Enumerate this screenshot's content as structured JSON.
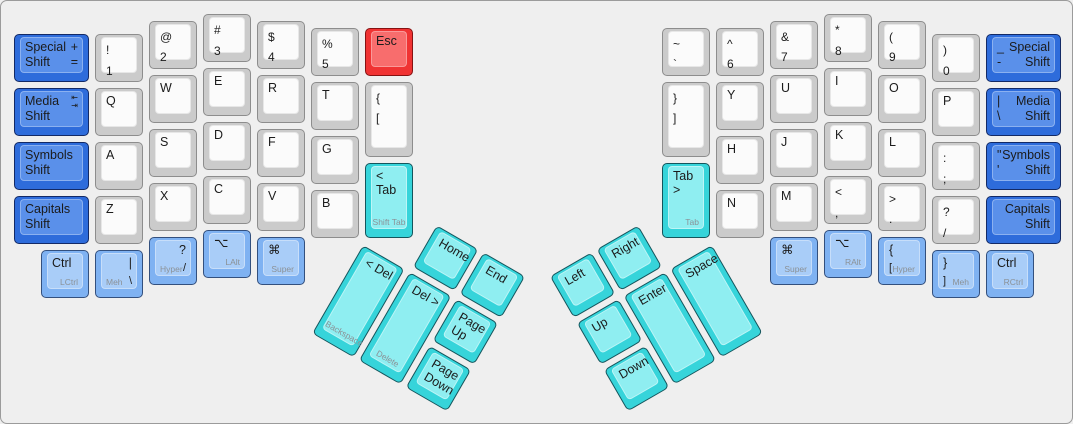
{
  "canvas": {
    "width": 1073,
    "height": 424,
    "background": "#efefef",
    "border_color": "#9b9b9b"
  },
  "unit_px": 54,
  "pad_px": 10,
  "inset_px": 3,
  "palette": {
    "white": {
      "base": "#cbcbcb",
      "top": "#fbfbfb",
      "border": "#8d8d8d",
      "topBorder": "rgba(0,0,0,0.08)"
    },
    "blue": {
      "base": "#2e6cdb",
      "top": "#5a90ea",
      "border": "#132a66",
      "topBorder": "rgba(255,255,255,0.30)"
    },
    "mod": {
      "base": "#7fb2f2",
      "top": "#a9cdf8",
      "border": "#33507e",
      "topBorder": "rgba(255,255,255,0.35)"
    },
    "cyan": {
      "base": "#36d4da",
      "top": "#8feef1",
      "border": "#14555c",
      "topBorder": "rgba(255,255,255,0.40)"
    },
    "red": {
      "base": "#f03333",
      "top": "#f86d6d",
      "border": "#861212",
      "topBorder": "rgba(255,255,255,0.30)"
    }
  },
  "keys": [
    {
      "n": "key-special-shift-left",
      "x": 0,
      "y": 0.375,
      "w": 1.5,
      "c": "blue",
      "l": [
        [
          "tl",
          "main",
          "Special\nShift"
        ],
        [
          "tr",
          "main",
          "+\n="
        ]
      ]
    },
    {
      "n": "key-media-shift-left",
      "x": 0,
      "y": 1.375,
      "w": 1.5,
      "c": "blue",
      "l": [
        [
          "tl",
          "main",
          "Media\nShift"
        ],
        [
          "tr",
          "icon",
          "⇤\n⇥",
          "tab-arrows-icon"
        ]
      ]
    },
    {
      "n": "key-symbols-shift-left",
      "x": 0,
      "y": 2.375,
      "w": 1.5,
      "c": "blue",
      "l": [
        [
          "tl",
          "main",
          "Symbols\nShift"
        ]
      ]
    },
    {
      "n": "key-capitals-shift-left",
      "x": 0,
      "y": 3.375,
      "w": 1.5,
      "c": "blue",
      "l": [
        [
          "tl",
          "main",
          "Capitals\nShift"
        ]
      ]
    },
    {
      "n": "key-1",
      "x": 1.5,
      "y": 0.375,
      "c": "white",
      "l": [
        [
          "tl",
          "pair",
          "!\n1"
        ]
      ]
    },
    {
      "n": "key-q",
      "x": 1.5,
      "y": 1.375,
      "c": "white",
      "l": [
        [
          "tl",
          "main",
          "Q"
        ]
      ]
    },
    {
      "n": "key-a",
      "x": 1.5,
      "y": 2.375,
      "c": "white",
      "l": [
        [
          "tl",
          "main",
          "A"
        ]
      ]
    },
    {
      "n": "key-z",
      "x": 1.5,
      "y": 3.375,
      "c": "white",
      "l": [
        [
          "tl",
          "main",
          "Z"
        ]
      ]
    },
    {
      "n": "key-2",
      "x": 2.5,
      "y": 0.125,
      "c": "white",
      "l": [
        [
          "tl",
          "pair",
          "@\n2"
        ]
      ]
    },
    {
      "n": "key-w",
      "x": 2.5,
      "y": 1.125,
      "c": "white",
      "l": [
        [
          "tl",
          "main",
          "W"
        ]
      ]
    },
    {
      "n": "key-s",
      "x": 2.5,
      "y": 2.125,
      "c": "white",
      "l": [
        [
          "tl",
          "main",
          "S"
        ]
      ]
    },
    {
      "n": "key-x",
      "x": 2.5,
      "y": 3.125,
      "c": "white",
      "l": [
        [
          "tl",
          "main",
          "X"
        ]
      ]
    },
    {
      "n": "key-3",
      "x": 3.5,
      "y": 0,
      "c": "white",
      "l": [
        [
          "tl",
          "pair",
          "#\n3"
        ]
      ]
    },
    {
      "n": "key-e",
      "x": 3.5,
      "y": 1,
      "c": "white",
      "l": [
        [
          "tl",
          "main",
          "E"
        ]
      ]
    },
    {
      "n": "key-d",
      "x": 3.5,
      "y": 2,
      "c": "white",
      "l": [
        [
          "tl",
          "main",
          "D"
        ]
      ]
    },
    {
      "n": "key-c",
      "x": 3.5,
      "y": 3,
      "c": "white",
      "l": [
        [
          "tl",
          "main",
          "C"
        ]
      ]
    },
    {
      "n": "key-4",
      "x": 4.5,
      "y": 0.125,
      "c": "white",
      "l": [
        [
          "tl",
          "pair",
          "$\n4"
        ]
      ]
    },
    {
      "n": "key-r",
      "x": 4.5,
      "y": 1.125,
      "c": "white",
      "l": [
        [
          "tl",
          "main",
          "R"
        ]
      ]
    },
    {
      "n": "key-f",
      "x": 4.5,
      "y": 2.125,
      "c": "white",
      "l": [
        [
          "tl",
          "main",
          "F"
        ]
      ]
    },
    {
      "n": "key-v",
      "x": 4.5,
      "y": 3.125,
      "c": "white",
      "l": [
        [
          "tl",
          "main",
          "V"
        ]
      ]
    },
    {
      "n": "key-5",
      "x": 5.5,
      "y": 0.25,
      "c": "white",
      "l": [
        [
          "tl",
          "pair",
          "%\n5"
        ]
      ]
    },
    {
      "n": "key-t",
      "x": 5.5,
      "y": 1.25,
      "c": "white",
      "l": [
        [
          "tl",
          "main",
          "T"
        ]
      ]
    },
    {
      "n": "key-g",
      "x": 5.5,
      "y": 2.25,
      "c": "white",
      "l": [
        [
          "tl",
          "main",
          "G"
        ]
      ]
    },
    {
      "n": "key-b",
      "x": 5.5,
      "y": 3.25,
      "c": "white",
      "l": [
        [
          "tl",
          "main",
          "B"
        ]
      ]
    },
    {
      "n": "key-esc",
      "x": 6.5,
      "y": 0.25,
      "c": "red",
      "l": [
        [
          "tl",
          "main",
          "Esc"
        ]
      ]
    },
    {
      "n": "key-lbracket-left",
      "x": 6.5,
      "y": 1.25,
      "h": 1.5,
      "c": "white",
      "l": [
        [
          "tl",
          "pair",
          "{\n["
        ]
      ]
    },
    {
      "n": "key-tab-left",
      "x": 6.5,
      "y": 2.75,
      "h": 1.5,
      "c": "cyan",
      "l": [
        [
          "tl",
          "main",
          "< Tab"
        ],
        [
          "bc",
          "sub",
          "Shift Tab"
        ]
      ]
    },
    {
      "n": "key-lctrl",
      "x": 0.5,
      "y": 4.375,
      "c": "mod",
      "l": [
        [
          "tl",
          "main",
          "Ctrl"
        ],
        [
          "lr",
          "sub",
          "LCtrl"
        ]
      ]
    },
    {
      "n": "key-meh-left",
      "x": 1.5,
      "y": 4.375,
      "c": "mod",
      "l": [
        [
          "tr",
          "main",
          "|"
        ],
        [
          "ll",
          "sub",
          "Meh"
        ],
        [
          "lr",
          "sym",
          "\\"
        ]
      ]
    },
    {
      "n": "key-hyper-left",
      "x": 2.5,
      "y": 4.125,
      "c": "mod",
      "l": [
        [
          "tr",
          "main",
          "?"
        ],
        [
          "ll",
          "sub",
          "Hyper"
        ],
        [
          "lr",
          "sym",
          "/"
        ]
      ]
    },
    {
      "n": "key-lalt",
      "x": 3.5,
      "y": 4,
      "c": "mod",
      "l": [
        [
          "tl",
          "main",
          "⌥",
          "option-icon"
        ],
        [
          "lr",
          "sub",
          "LAlt"
        ]
      ]
    },
    {
      "n": "key-super-left",
      "x": 4.5,
      "y": 4.125,
      "c": "mod",
      "l": [
        [
          "tl",
          "main",
          "⌘",
          "command-icon"
        ],
        [
          "lr",
          "sub",
          "Super"
        ]
      ]
    },
    {
      "n": "key-home",
      "x": 7.5,
      "y": 3.25,
      "c": "cyan",
      "r": 30,
      "rx": 6.5,
      "ry": 4.25,
      "l": [
        [
          "tl",
          "main",
          "Home"
        ]
      ]
    },
    {
      "n": "key-end",
      "x": 8.5,
      "y": 3.25,
      "c": "cyan",
      "r": 30,
      "rx": 6.5,
      "ry": 4.25,
      "l": [
        [
          "tl",
          "main",
          "End"
        ]
      ]
    },
    {
      "n": "key-backspace",
      "x": 6.5,
      "y": 4.25,
      "h": 2,
      "c": "cyan",
      "r": 30,
      "rx": 6.5,
      "ry": 4.25,
      "l": [
        [
          "tl",
          "main",
          "< Del"
        ],
        [
          "bc",
          "sub",
          "Backspace"
        ]
      ]
    },
    {
      "n": "key-delete",
      "x": 7.5,
      "y": 4.25,
      "h": 2,
      "c": "cyan",
      "r": 30,
      "rx": 6.5,
      "ry": 4.25,
      "l": [
        [
          "tl",
          "main",
          "Del >"
        ],
        [
          "bc",
          "sub",
          "Delete"
        ]
      ]
    },
    {
      "n": "key-page-up",
      "x": 8.5,
      "y": 4.25,
      "c": "cyan",
      "r": 30,
      "rx": 6.5,
      "ry": 4.25,
      "l": [
        [
          "tl",
          "main",
          "Page\nUp"
        ]
      ]
    },
    {
      "n": "key-page-down",
      "x": 8.5,
      "y": 5.25,
      "c": "cyan",
      "r": 30,
      "rx": 6.5,
      "ry": 4.25,
      "l": [
        [
          "tl",
          "main",
          "Page\nDown"
        ]
      ]
    },
    {
      "n": "key-left",
      "x": 10,
      "y": 3.25,
      "c": "cyan",
      "r": -30,
      "rx": 13,
      "ry": 4.25,
      "l": [
        [
          "tl",
          "main",
          "Left"
        ]
      ]
    },
    {
      "n": "key-right",
      "x": 11,
      "y": 3.25,
      "c": "cyan",
      "r": -30,
      "rx": 13,
      "ry": 4.25,
      "l": [
        [
          "tl",
          "main",
          "Right"
        ]
      ]
    },
    {
      "n": "key-up",
      "x": 10,
      "y": 4.25,
      "c": "cyan",
      "r": -30,
      "rx": 13,
      "ry": 4.25,
      "l": [
        [
          "tl",
          "main",
          "Up"
        ]
      ]
    },
    {
      "n": "key-enter",
      "x": 11,
      "y": 4.25,
      "h": 2,
      "c": "cyan",
      "r": -30,
      "rx": 13,
      "ry": 4.25,
      "l": [
        [
          "tl",
          "main",
          "Enter"
        ]
      ]
    },
    {
      "n": "key-space",
      "x": 12,
      "y": 4.25,
      "h": 2,
      "c": "cyan",
      "r": -30,
      "rx": 13,
      "ry": 4.25,
      "l": [
        [
          "tl",
          "main",
          "Space"
        ]
      ]
    },
    {
      "n": "key-down",
      "x": 10,
      "y": 5.25,
      "c": "cyan",
      "r": -30,
      "rx": 13,
      "ry": 4.25,
      "l": [
        [
          "tl",
          "main",
          "Down"
        ]
      ]
    },
    {
      "n": "key-tilde",
      "x": 12,
      "y": 0.25,
      "c": "white",
      "l": [
        [
          "tl",
          "pair",
          "~\n`"
        ]
      ]
    },
    {
      "n": "key-rbracket-right",
      "x": 12,
      "y": 1.25,
      "h": 1.5,
      "c": "white",
      "l": [
        [
          "tl",
          "pair",
          "}\n]"
        ]
      ]
    },
    {
      "n": "key-tab-right",
      "x": 12,
      "y": 2.75,
      "h": 1.5,
      "c": "cyan",
      "l": [
        [
          "tl",
          "main",
          "Tab >"
        ],
        [
          "lr",
          "sub",
          "Tab"
        ]
      ]
    },
    {
      "n": "key-6",
      "x": 13,
      "y": 0.25,
      "c": "white",
      "l": [
        [
          "tl",
          "pair",
          "^\n6"
        ]
      ]
    },
    {
      "n": "key-y",
      "x": 13,
      "y": 1.25,
      "c": "white",
      "l": [
        [
          "tl",
          "main",
          "Y"
        ]
      ]
    },
    {
      "n": "key-h",
      "x": 13,
      "y": 2.25,
      "c": "white",
      "l": [
        [
          "tl",
          "main",
          "H"
        ]
      ]
    },
    {
      "n": "key-n",
      "x": 13,
      "y": 3.25,
      "c": "white",
      "l": [
        [
          "tl",
          "main",
          "N"
        ]
      ]
    },
    {
      "n": "key-7",
      "x": 14,
      "y": 0.125,
      "c": "white",
      "l": [
        [
          "tl",
          "pair",
          "&\n7"
        ]
      ]
    },
    {
      "n": "key-u",
      "x": 14,
      "y": 1.125,
      "c": "white",
      "l": [
        [
          "tl",
          "main",
          "U"
        ]
      ]
    },
    {
      "n": "key-j",
      "x": 14,
      "y": 2.125,
      "c": "white",
      "l": [
        [
          "tl",
          "main",
          "J"
        ]
      ]
    },
    {
      "n": "key-m",
      "x": 14,
      "y": 3.125,
      "c": "white",
      "l": [
        [
          "tl",
          "main",
          "M"
        ]
      ]
    },
    {
      "n": "key-8",
      "x": 15,
      "y": 0,
      "c": "white",
      "l": [
        [
          "tl",
          "pair",
          "*\n8"
        ]
      ]
    },
    {
      "n": "key-i",
      "x": 15,
      "y": 1,
      "c": "white",
      "l": [
        [
          "tl",
          "main",
          "I"
        ]
      ]
    },
    {
      "n": "key-k",
      "x": 15,
      "y": 2,
      "c": "white",
      "l": [
        [
          "tl",
          "main",
          "K"
        ]
      ]
    },
    {
      "n": "key-comma",
      "x": 15,
      "y": 3,
      "c": "white",
      "l": [
        [
          "tl",
          "pair",
          "<\n,"
        ]
      ]
    },
    {
      "n": "key-9",
      "x": 16,
      "y": 0.125,
      "c": "white",
      "l": [
        [
          "tl",
          "pair",
          "(\n9"
        ]
      ]
    },
    {
      "n": "key-o",
      "x": 16,
      "y": 1.125,
      "c": "white",
      "l": [
        [
          "tl",
          "main",
          "O"
        ]
      ]
    },
    {
      "n": "key-l",
      "x": 16,
      "y": 2.125,
      "c": "white",
      "l": [
        [
          "tl",
          "main",
          "L"
        ]
      ]
    },
    {
      "n": "key-period",
      "x": 16,
      "y": 3.125,
      "c": "white",
      "l": [
        [
          "tl",
          "pair",
          ">\n."
        ]
      ]
    },
    {
      "n": "key-0",
      "x": 17,
      "y": 0.375,
      "c": "white",
      "l": [
        [
          "tl",
          "pair",
          ")\n0"
        ]
      ]
    },
    {
      "n": "key-p",
      "x": 17,
      "y": 1.375,
      "c": "white",
      "l": [
        [
          "tl",
          "main",
          "P"
        ]
      ]
    },
    {
      "n": "key-semicolon",
      "x": 17,
      "y": 2.375,
      "c": "white",
      "l": [
        [
          "tl",
          "pair",
          ":\n;"
        ]
      ]
    },
    {
      "n": "key-slash",
      "x": 17,
      "y": 3.375,
      "c": "white",
      "l": [
        [
          "tl",
          "pair",
          "?\n/"
        ]
      ]
    },
    {
      "n": "key-special-shift-right",
      "x": 18,
      "y": 0.375,
      "w": 1.5,
      "c": "blue",
      "l": [
        [
          "tl",
          "main",
          "_\n-"
        ],
        [
          "tr",
          "main",
          "Special\nShift"
        ]
      ]
    },
    {
      "n": "key-media-shift-right",
      "x": 18,
      "y": 1.375,
      "w": 1.5,
      "c": "blue",
      "l": [
        [
          "tl",
          "main",
          "|\n\\"
        ],
        [
          "tr",
          "main",
          "Media\nShift"
        ]
      ]
    },
    {
      "n": "key-symbols-shift-right",
      "x": 18,
      "y": 2.375,
      "w": 1.5,
      "c": "blue",
      "l": [
        [
          "tl",
          "main",
          "\"\n'"
        ],
        [
          "tr",
          "main",
          "Symbols\nShift"
        ]
      ]
    },
    {
      "n": "key-capitals-shift-right",
      "x": 18,
      "y": 3.375,
      "w": 1.5,
      "c": "blue",
      "l": [
        [
          "tr",
          "main",
          "Capitals\nShift"
        ]
      ]
    },
    {
      "n": "key-super-right",
      "x": 14,
      "y": 4.125,
      "c": "mod",
      "l": [
        [
          "tl",
          "main",
          "⌘",
          "command-icon"
        ],
        [
          "lr",
          "sub",
          "Super"
        ]
      ]
    },
    {
      "n": "key-ralt",
      "x": 15,
      "y": 4,
      "c": "mod",
      "l": [
        [
          "tl",
          "main",
          "⌥",
          "option-icon"
        ],
        [
          "lr",
          "sub",
          "RAlt"
        ]
      ]
    },
    {
      "n": "key-hyper-right",
      "x": 16,
      "y": 4.125,
      "c": "mod",
      "l": [
        [
          "tl",
          "main",
          "{"
        ],
        [
          "ll",
          "sym",
          "["
        ],
        [
          "lr",
          "sub",
          "Hyper"
        ]
      ]
    },
    {
      "n": "key-meh-right",
      "x": 17,
      "y": 4.375,
      "c": "mod",
      "l": [
        [
          "tl",
          "main",
          "}"
        ],
        [
          "ll",
          "sym",
          "]"
        ],
        [
          "lr",
          "sub",
          "Meh"
        ]
      ]
    },
    {
      "n": "key-rctrl",
      "x": 18,
      "y": 4.375,
      "c": "mod",
      "l": [
        [
          "tl",
          "main",
          "Ctrl"
        ],
        [
          "lr",
          "sub",
          "RCtrl"
        ]
      ]
    }
  ]
}
